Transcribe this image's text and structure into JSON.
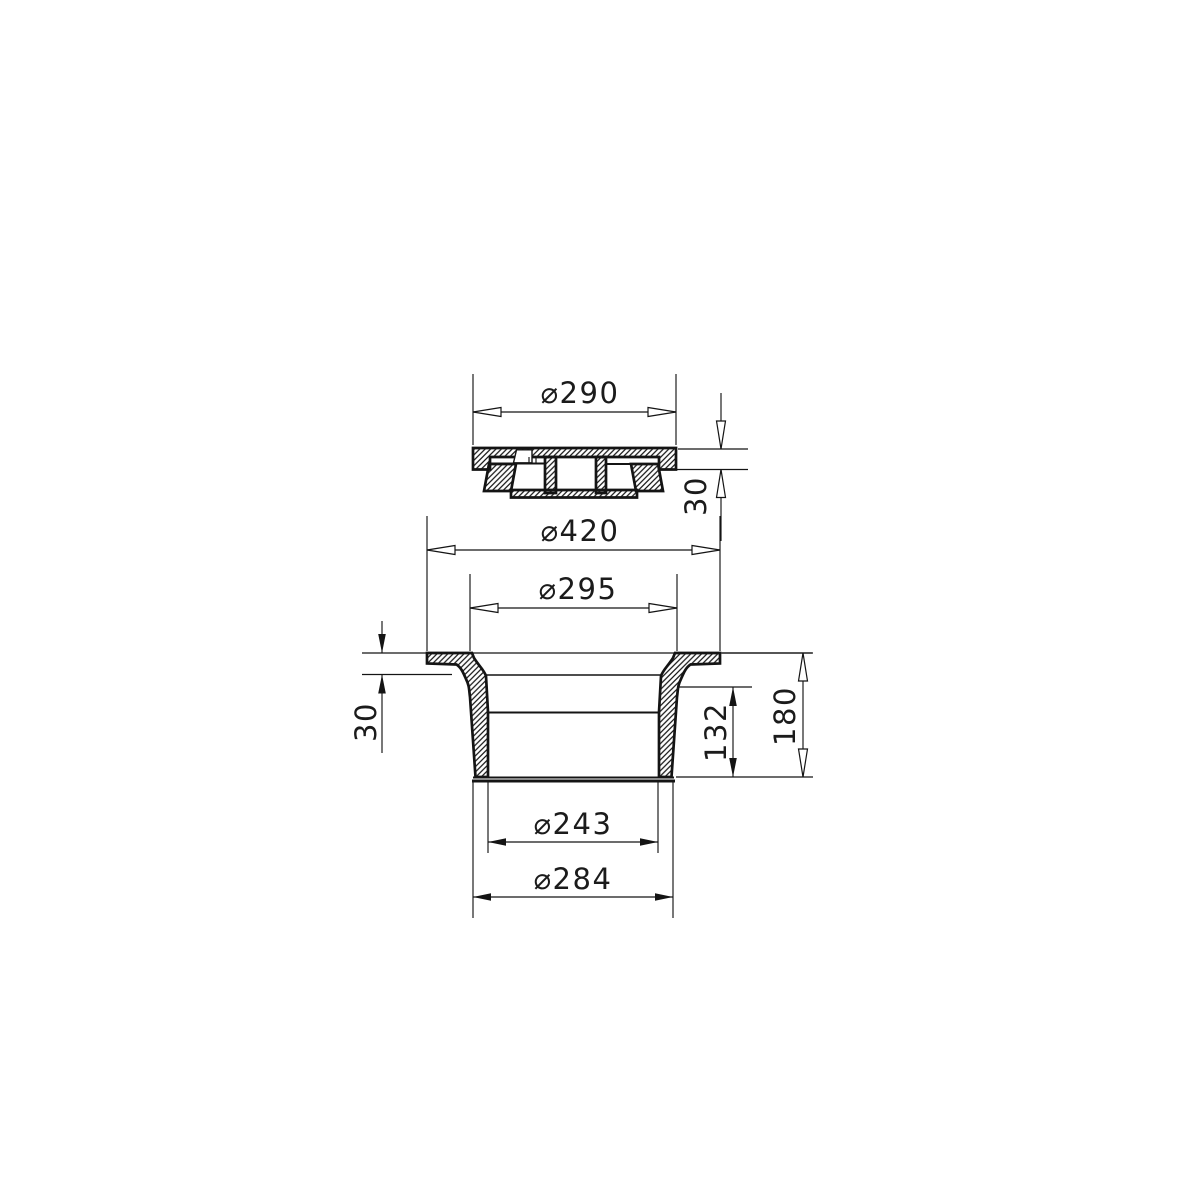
{
  "drawing": {
    "background_color": "#ffffff",
    "line_color": "#141414",
    "views": {
      "top_view": "lid-cross-section",
      "bottom_view": "frame-cross-section"
    },
    "dims": {
      "lid_diameter": "⌀290",
      "lid_edge_height": "30",
      "flange_diameter": "⌀420",
      "clear_opening_diameter": "⌀295",
      "seat_depth": "30",
      "lower_body_height": "132",
      "total_height": "180",
      "inner_diameter": "⌀243",
      "outer_diameter": "⌀284"
    }
  }
}
